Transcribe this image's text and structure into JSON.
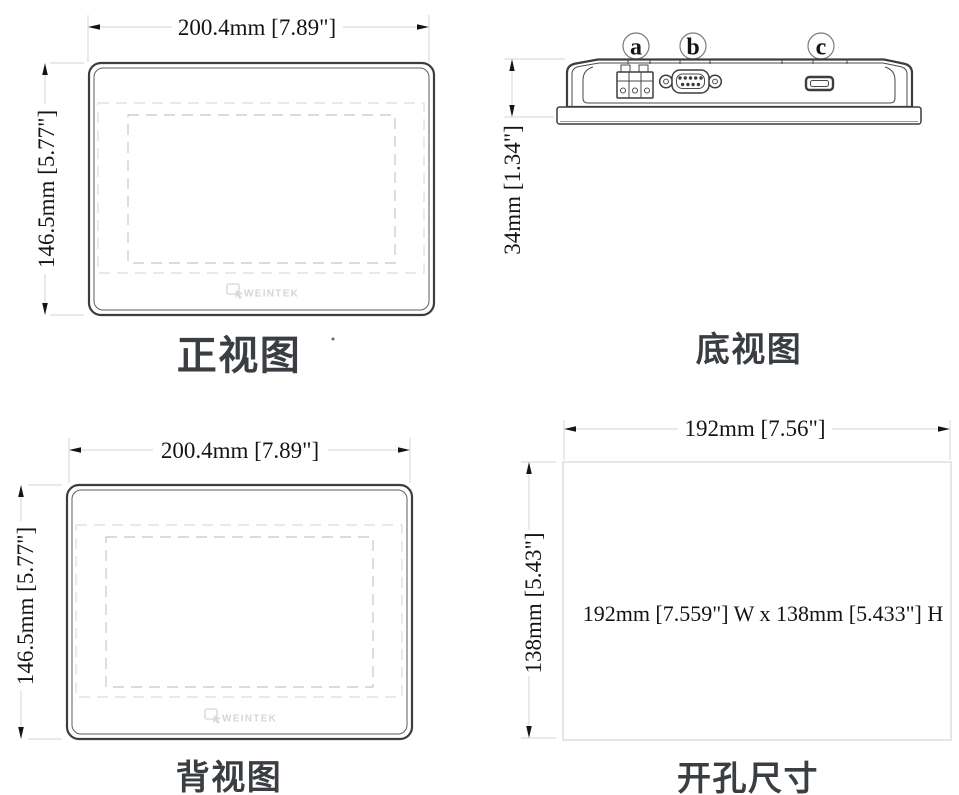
{
  "page": {
    "background": "#ffffff",
    "line_color": "#3d3d3d",
    "dim_line_color": "#dcdcdc",
    "text_color": "#141414",
    "title_color": "#3a3e42"
  },
  "views": {
    "front": {
      "title": "正视图",
      "width_dim": "200.4mm [7.89\"]",
      "height_dim": "146.5mm [5.77\"]",
      "logo": "WEINTEK"
    },
    "bottom": {
      "title": "底视图",
      "height_dim": "34mm [1.34\"]",
      "ports": [
        {
          "label": "a",
          "name": "power-terminal-block"
        },
        {
          "label": "b",
          "name": "db9-serial-port"
        },
        {
          "label": "c",
          "name": "usb-micro-port"
        }
      ]
    },
    "back": {
      "title": "背视图",
      "width_dim": "200.4mm [7.89\"]",
      "height_dim": "146.5mm [5.77\"]",
      "logo": "WEINTEK"
    },
    "cutout": {
      "title": "开孔尺寸",
      "width_dim": "192mm [7.56\"]",
      "height_dim": "138mm [5.43\"]",
      "center_note": "192mm [7.559\"] W x 138mm [5.433\"] H"
    }
  }
}
